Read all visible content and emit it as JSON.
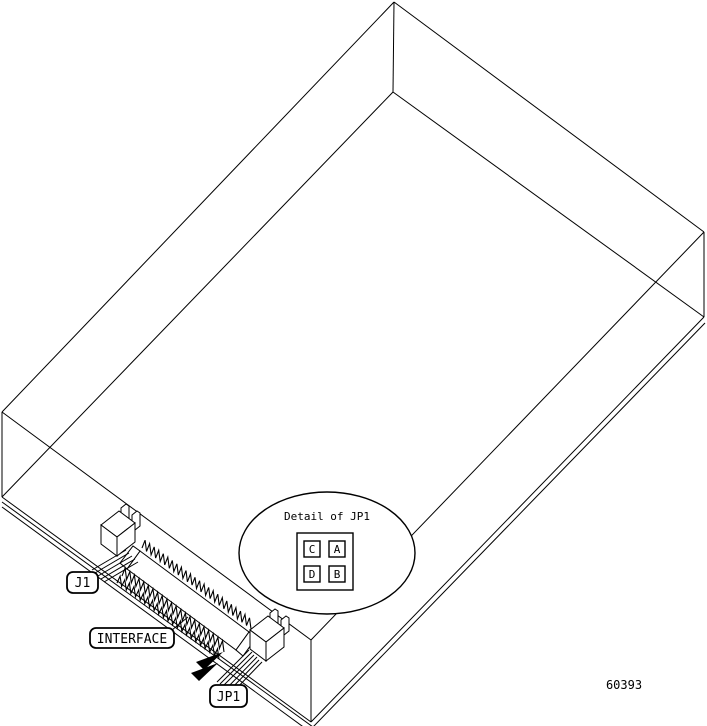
{
  "callout": {
    "title": "Detail of JP1",
    "jumpers": {
      "top_left": "C",
      "top_right": "A",
      "bottom_left": "D",
      "bottom_right": "B"
    }
  },
  "labels": {
    "power_connector": "J1",
    "interface": "INTERFACE",
    "jumper_block": "JP1"
  },
  "figure_number": "60393"
}
